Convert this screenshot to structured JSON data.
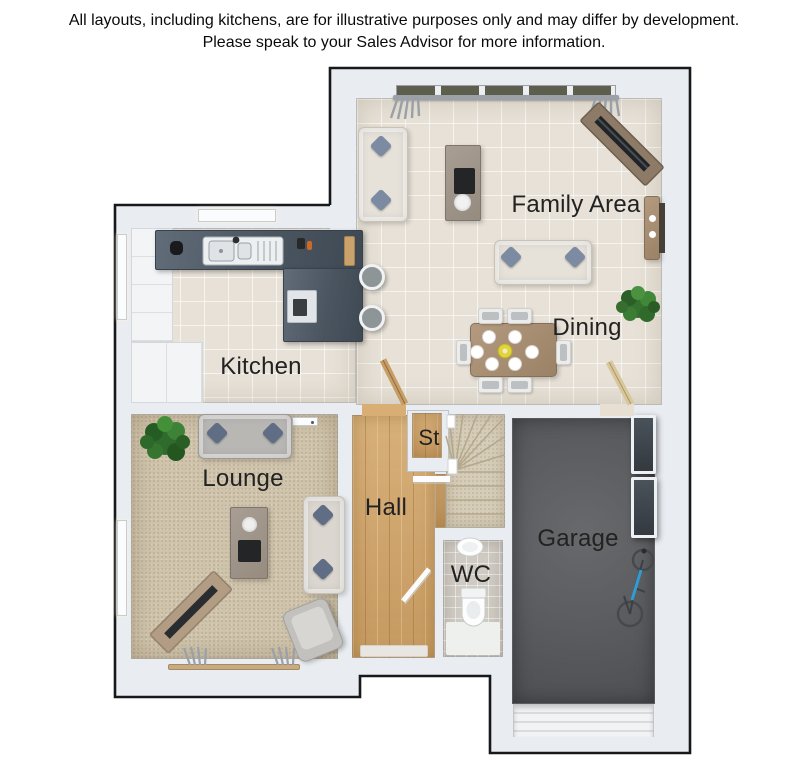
{
  "disclaimer": {
    "line1": "All layouts, including kitchens, are for illustrative purposes only and may differ by development.",
    "line2": "Please speak to your Sales Advisor for more information."
  },
  "rooms": {
    "family_area": {
      "label": "Family Area"
    },
    "dining": {
      "label": "Dining"
    },
    "kitchen": {
      "label": "Kitchen"
    },
    "lounge": {
      "label": "Lounge"
    },
    "hall": {
      "label": "Hall"
    },
    "store": {
      "label": "St"
    },
    "wc": {
      "label": "WC"
    },
    "garage": {
      "label": "Garage"
    }
  },
  "colors": {
    "wall": "#e9edf2",
    "outline": "#17181a",
    "tile_floor": "#e7e1d7",
    "lounge_carpet": "#cfc3ab",
    "hall_wood": "#d2a467",
    "garage_floor": "#595b5e",
    "kitchen_worktop": "#4a5560",
    "label_text": "#222222",
    "plant_green": "#36722f",
    "accent_pillow_blue": "#7d8ba2",
    "centerpiece_yellow": "#e0d33c"
  }
}
